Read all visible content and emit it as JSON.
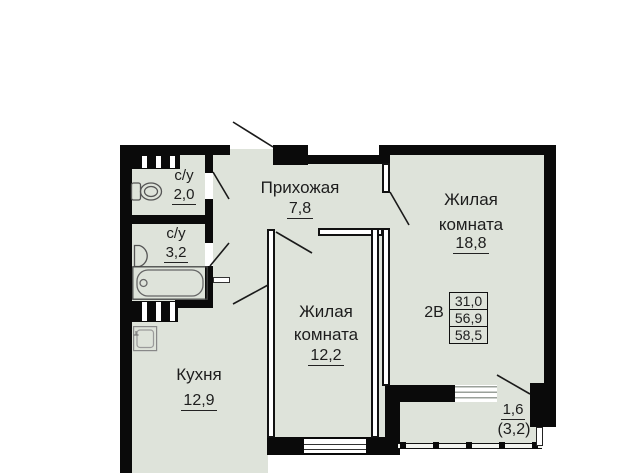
{
  "plan_type": "apartment-floor-plan",
  "rooms": {
    "wc1": {
      "label": "с/у",
      "area": "2,0"
    },
    "wc2": {
      "label": "с/у",
      "area": "3,2"
    },
    "hall": {
      "label": "Прихожая",
      "area": "7,8"
    },
    "living_main": {
      "label_line1": "Жилая",
      "label_line2": "комната",
      "area": "18,8"
    },
    "living_second": {
      "label_line1": "Жилая",
      "label_line2": "комната",
      "area": "12,2"
    },
    "kitchen": {
      "label": "Кухня",
      "area": "12,9"
    },
    "balcony": {
      "area_reduced": "1,6",
      "area_full": "(3,2)"
    }
  },
  "info_box": {
    "type_label": "2В",
    "living_area": "31,0",
    "area_no_balcony": "56,9",
    "total_area": "58,5"
  },
  "icons": {
    "toilet": "toilet-icon",
    "sink": "sink-icon",
    "bathtub": "bathtub-icon",
    "kitchen_sink": "kitchen-sink-icon"
  },
  "colors": {
    "floor": "#dee3da",
    "wall": "#0a0a0a",
    "line": "#1a1a1a",
    "background": "#ffffff"
  }
}
